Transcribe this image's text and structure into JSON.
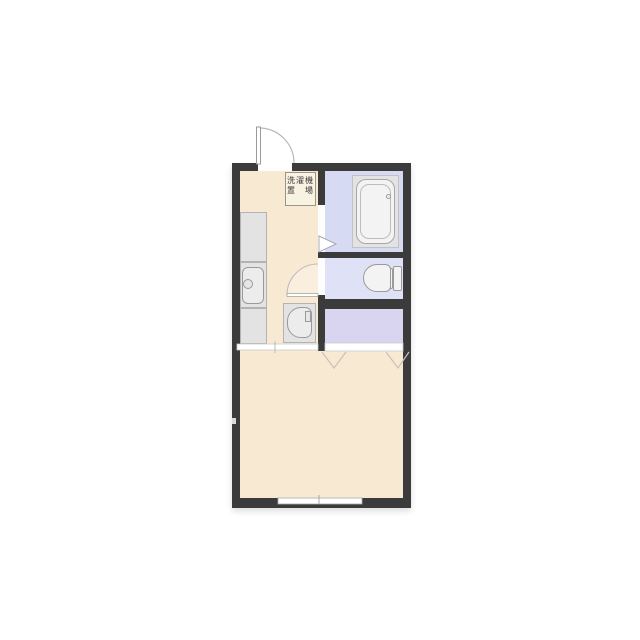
{
  "floorplan": {
    "type": "japanese-apartment-1k-floorplan",
    "washing_machine_area": {
      "line1": "洗濯機",
      "line2": "置　場"
    },
    "colors": {
      "wall": "#3b3b3b",
      "floor_kitchen_and_main_room": "#f8e9d3",
      "floor_bathroom": "#d6daf2",
      "floor_toilet": "#dfe2f6",
      "floor_closet": "#d9d4f0",
      "fixture_panel": "#e3e3e3",
      "fixture_white": "#f3f3f3",
      "background": "#ffffff"
    }
  }
}
